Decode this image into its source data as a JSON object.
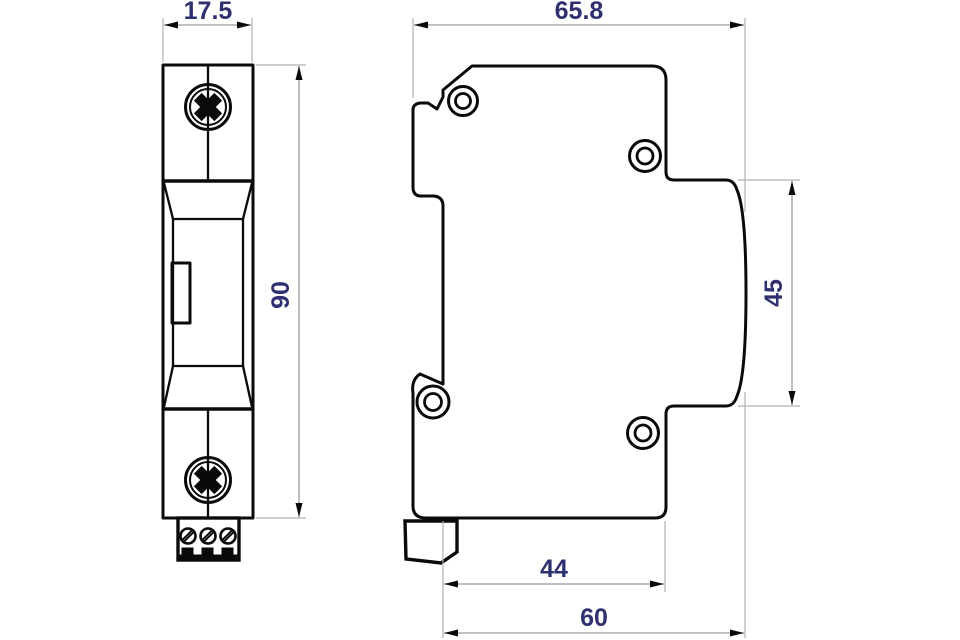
{
  "drawing": {
    "kind": "technical dimension drawing",
    "views": {
      "front_view": "front view of DIN-rail module",
      "side_view": "side view of DIN-rail module"
    }
  },
  "dimensions": {
    "front_width": "17.5",
    "front_height": "90",
    "side_width": "65.8",
    "side_face_height": "45",
    "bottom_inner_depth": "44",
    "bottom_outer_depth": "60"
  },
  "colors": {
    "background": "#ffffff",
    "part_outline": "#0a0a0a",
    "dimension_line": "#9a9a9a",
    "dimension_text": "#2e3070"
  }
}
